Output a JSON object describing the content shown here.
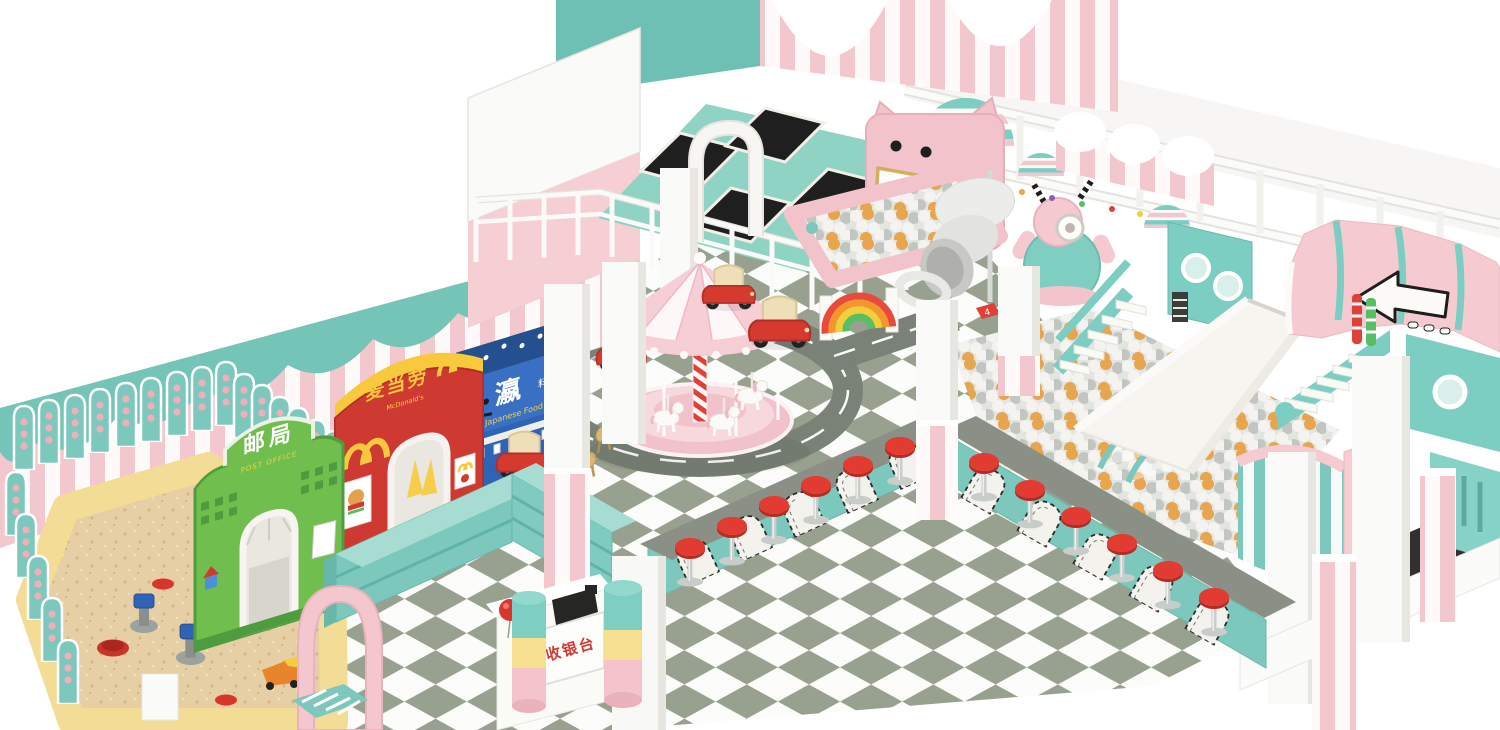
{
  "scene": {
    "type": "3d-render",
    "setting": "pastel indoor kids playground, isometric overview",
    "palette": {
      "pink": "#F4C6CD",
      "light_pink": "#F8DCE0",
      "teal": "#74C4B8",
      "mint_deck": "#8FD3C4",
      "floor_tile_green": "#98A08F",
      "floor_tile_white": "#FCFCFA",
      "road_gray": "#7A8177",
      "sand": "#E6CFA4",
      "sand_border": "#F3DC95",
      "red": "#D63A2E",
      "yellow": "#F8C93D",
      "green_shop": "#6FBE4E",
      "blue_shop": "#2E63B5",
      "ball_orange": "#E7A54D",
      "ball_gray": "#C2C6C0",
      "counter_top": "#8A9086",
      "slide_white": "#F6F4EE",
      "trampoline_mat": "#1F1F1F"
    },
    "signs": {
      "post_office": {
        "cn": "邮局",
        "en": "POST OFFICE"
      },
      "mcdonalds": {
        "cn": "麦当劳",
        "en": "McDonald's"
      },
      "japanese_food": {
        "cn_main": "瀛",
        "cn_sub": "料理",
        "en": "Japanese Food"
      },
      "cashier": {
        "cn": "收银台"
      },
      "hopscotch_number": "4"
    },
    "features": [
      "sand pit with diggers and toys",
      "post office playhouse",
      "mcdonalds playhouse",
      "japanese food playhouse",
      "toy shelves",
      "cashier desk",
      "carousel with horses",
      "road circuit with toy cars",
      "trampoline court",
      "tv-face ball pit",
      "spiral tube slide",
      "rainbow climber",
      "robot mascot",
      "striped domes",
      "big ball pit",
      "wide white slide",
      "teal staircases",
      "snack counter with red stools",
      "pink train canopy with direction arrow",
      "spiral slide tower"
    ]
  }
}
